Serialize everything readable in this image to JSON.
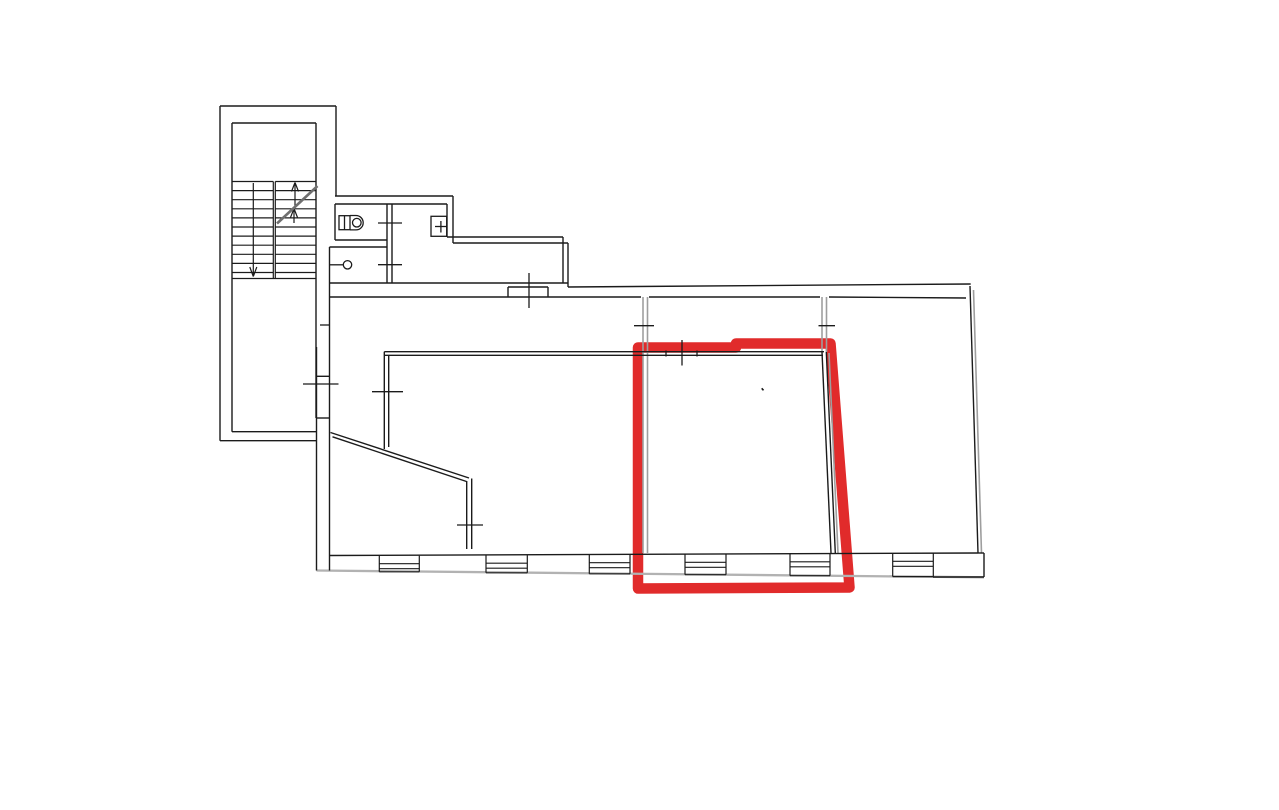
{
  "canvas": {
    "width": 1279,
    "height": 810,
    "background": "#ffffff"
  },
  "palette": {
    "wall": "#1b1b1b",
    "gray_wall": "#9e9e9e",
    "exterior_gray": "#b2b2b2",
    "break_line": "#6f6f6f",
    "highlight_red": "#e12b2b"
  },
  "highlight": {
    "shape": "room-outline-marker",
    "points": [
      [
        638,
        347.5
      ],
      [
        736,
        347.5
      ],
      [
        736,
        343.5
      ],
      [
        830.5,
        343.5
      ],
      [
        849.5,
        587.5
      ],
      [
        638,
        588.5
      ]
    ],
    "stroke_width": 10.5
  },
  "walls": {
    "black_width": 1.4,
    "gray_width": 1.6,
    "black_segments": [
      [
        336,
        106,
        220,
        106
      ],
      [
        220,
        106,
        220,
        440.7
      ],
      [
        220,
        440.7,
        316.5,
        440.7
      ],
      [
        336,
        106,
        336,
        196
      ],
      [
        232,
        123,
        316,
        123
      ],
      [
        232,
        123,
        232,
        431.7
      ],
      [
        232,
        431.7,
        316,
        431.7
      ],
      [
        316,
        123,
        316,
        418
      ],
      [
        316.5,
        347,
        316.5,
        570.5
      ],
      [
        316.5,
        418,
        329.5,
        418
      ],
      [
        316.5,
        376.3,
        329.5,
        376.3
      ],
      [
        329.5,
        247,
        329.5,
        570.5
      ],
      [
        329.5,
        297,
        508,
        297
      ],
      [
        548,
        297,
        641,
        297
      ],
      [
        649,
        297,
        820,
        297
      ],
      [
        829,
        297,
        966,
        298
      ],
      [
        568,
        287,
        970.7,
        284
      ],
      [
        970,
        286,
        978,
        553
      ],
      [
        329.5,
        555.5,
        978,
        553
      ],
      [
        978,
        553,
        984,
        553
      ],
      [
        984,
        553,
        984,
        577
      ],
      [
        933,
        577,
        984,
        577
      ],
      [
        335,
        196,
        453,
        196
      ],
      [
        453,
        196,
        453,
        243
      ],
      [
        453,
        243,
        568,
        243
      ],
      [
        568,
        243,
        568,
        287
      ],
      [
        335,
        204,
        447,
        204
      ],
      [
        447,
        204,
        447,
        237
      ],
      [
        447,
        237,
        563,
        237
      ],
      [
        563,
        237,
        563,
        283
      ],
      [
        329.5,
        283,
        568,
        283
      ],
      [
        335,
        204,
        335,
        240
      ],
      [
        335,
        240,
        387,
        240
      ],
      [
        387,
        204,
        387,
        283
      ],
      [
        392,
        204,
        392,
        283
      ],
      [
        329.5,
        247,
        387,
        247
      ],
      [
        508,
        287,
        548,
        287
      ],
      [
        508,
        287,
        508,
        297
      ],
      [
        548,
        287,
        548,
        297
      ],
      [
        508,
        297,
        548,
        297
      ],
      [
        384.3,
        351.7,
        824,
        351.7
      ],
      [
        384.3,
        355.3,
        823,
        355.3
      ],
      [
        384.3,
        351.7,
        384.3,
        449
      ],
      [
        388.7,
        355.3,
        388.7,
        447
      ],
      [
        822,
        352,
        831,
        553
      ],
      [
        826.3,
        352,
        835.3,
        553
      ],
      [
        330.5,
        432.5,
        469,
        478
      ],
      [
        332.5,
        436.8,
        466.5,
        481.5
      ],
      [
        466.7,
        481,
        466.7,
        549
      ],
      [
        471.7,
        478.5,
        471.7,
        549
      ]
    ],
    "gray_segments": [
      [
        643,
        297,
        643,
        553
      ],
      [
        647.5,
        297,
        647.5,
        553
      ],
      [
        822,
        297,
        822,
        352
      ],
      [
        826.5,
        297,
        826.5,
        352
      ],
      [
        829,
        353,
        838,
        553
      ],
      [
        973.5,
        290,
        981.5,
        553
      ]
    ],
    "exterior_segment": [
      316.5,
      570.5,
      984,
      577.3
    ],
    "exterior_width": 2.3
  },
  "door_ticks": {
    "width": 1.3,
    "segments": [
      [
        378,
        223,
        402,
        223
      ],
      [
        378,
        264.7,
        402,
        264.7
      ],
      [
        529,
        273,
        529,
        308
      ],
      [
        372,
        391.7,
        403,
        391.7
      ],
      [
        666,
        350.5,
        666,
        356.5
      ],
      [
        697,
        350.5,
        697,
        356.5
      ],
      [
        682,
        340,
        682,
        365.5
      ],
      [
        634,
        325.7,
        654,
        325.7
      ],
      [
        818.5,
        325.7,
        835,
        325.7
      ],
      [
        320,
        325,
        329.5,
        325
      ],
      [
        303,
        384,
        338.5,
        384
      ],
      [
        457,
        525,
        483,
        525
      ]
    ]
  },
  "stairs": {
    "step_width": 1.2,
    "left_flight_x": [
      232,
      273.3
    ],
    "right_flight_x": [
      275.3,
      316
    ],
    "step_ys": [
      181.5,
      190.6,
      199.7,
      208.8,
      217.9,
      227,
      236.1,
      245.2,
      254.3,
      263.4,
      272.5
    ],
    "bottom_edge": [
      232,
      278.5,
      316,
      278.5
    ],
    "dividers": [
      [
        273.3,
        181.5,
        273.3,
        278.5
      ],
      [
        275.3,
        181.5,
        275.3,
        278.5
      ]
    ],
    "down_arrow": {
      "shaft": [
        253.3,
        183,
        253.3,
        275
      ],
      "head": [
        [
          249.8,
          267,
          253.3,
          276.5
        ],
        [
          256.8,
          267,
          253.3,
          276.5
        ]
      ]
    },
    "up_arrow_upper": {
      "shaft": [
        295,
        184,
        295,
        206.5
      ],
      "head": [
        [
          291.5,
          191.5,
          295,
          182.5
        ],
        [
          298.5,
          191.5,
          295,
          182.5
        ]
      ]
    },
    "up_arrow_lower": {
      "shaft": [
        294,
        210.5,
        294,
        223
      ],
      "head": [
        [
          290.5,
          217.5,
          294,
          208.5
        ],
        [
          297.5,
          217.5,
          294,
          208.5
        ]
      ]
    },
    "break_line": {
      "segment": [
        277,
        223.5,
        317.5,
        186
      ],
      "width": 2.6
    }
  },
  "windows": [
    {
      "x1": 379.3,
      "x2": 419.3,
      "top": 555.7,
      "bottom": 571.8
    },
    {
      "x1": 486,
      "x2": 527.3,
      "top": 555.2,
      "bottom": 572.8
    },
    {
      "x1": 589.3,
      "x2": 630,
      "top": 554.7,
      "bottom": 573.8
    },
    {
      "x1": 685,
      "x2": 726,
      "top": 554.3,
      "bottom": 574.7
    },
    {
      "x1": 790,
      "x2": 830,
      "top": 553.8,
      "bottom": 575.7
    },
    {
      "x1": 892.7,
      "x2": 933.3,
      "top": 553.3,
      "bottom": 576.6
    }
  ],
  "fixtures": {
    "stroke_width": 1.3,
    "toilet": {
      "tank_rect": [
        339,
        215.7,
        11,
        14
      ],
      "tank_divider": [
        344.5,
        215.7,
        344.5,
        229.7
      ],
      "bowl_path": "M350,215.5 L356,215.5 A7.2,7.2 0 0 1 356,229.9 L350,229.9",
      "seat_circle": [
        356.8,
        222.7,
        4.3
      ]
    },
    "washbasin": {
      "circle": [
        347.5,
        264.8,
        4.2
      ],
      "line": [
        329.5,
        264.8,
        343.3,
        264.8
      ]
    },
    "sink": {
      "rect": [
        431,
        216.3,
        15.7,
        20
      ],
      "cross_v": [
        440.9,
        221,
        440.9,
        232.5
      ],
      "cross_h": [
        435,
        226.5,
        446.7,
        226.5
      ]
    }
  },
  "pen_mark": [
    761.7,
    388.3,
    763.5,
    390.3
  ]
}
